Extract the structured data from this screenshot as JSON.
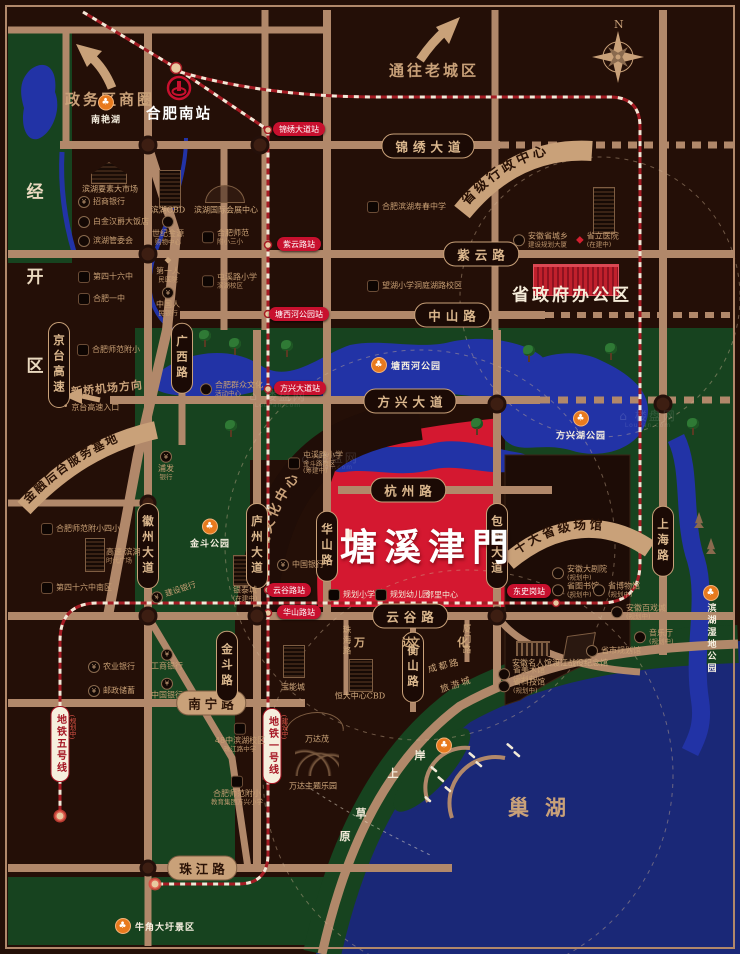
{
  "colors": {
    "bg": "#240f07",
    "road": "#b1886a",
    "green": "#17431f",
    "water": "#2233a6",
    "chaohu": "#1a2877",
    "red_area": "#d41830",
    "metro_red": "#a51c24",
    "tan": "#c9a179",
    "station_red": "#c8102e"
  },
  "compass": {
    "label": "N"
  },
  "project": {
    "name": "塘溪津門"
  },
  "banners": {
    "admin": "省级行政中心",
    "finance": "金融后台服务基地",
    "culture": "环湖文化中心",
    "venues": "十大省级场馆"
  },
  "watermark": {
    "text": "⌂ 楼盘网",
    "sub": "LouPan.com"
  },
  "metro": {
    "line1": {
      "name": "地铁一号线",
      "status": "(建设中)"
    },
    "line5": {
      "name": "地铁五号线",
      "status": "(规划中)"
    }
  },
  "items": [
    {
      "t": "pill-h",
      "id": "road-jinxiu-avenue",
      "x": 428,
      "y": 146,
      "tx": "锦绣大道"
    },
    {
      "t": "pill-h",
      "id": "road-ziyun-road",
      "x": 481,
      "y": 254,
      "tx": "紫云路"
    },
    {
      "t": "pill-h",
      "id": "road-zhongshan-road",
      "x": 452,
      "y": 315,
      "tx": "中山路"
    },
    {
      "t": "pill-h",
      "id": "road-fangxing-avenue",
      "x": 410,
      "y": 401,
      "tx": "方兴大道"
    },
    {
      "t": "pill-h",
      "id": "road-hangzhou-road",
      "x": 408,
      "y": 490,
      "tx": "杭州路"
    },
    {
      "t": "pill-h",
      "id": "road-yungu-road",
      "x": 410,
      "y": 616,
      "tx": "云谷路"
    },
    {
      "t": "pill-tan",
      "id": "road-nanning-road",
      "x": 211,
      "y": 703,
      "tx": "南宁路"
    },
    {
      "t": "pill-tan",
      "id": "road-zhujiang-road",
      "x": 202,
      "y": 868,
      "tx": "珠江路"
    },
    {
      "t": "pill-v",
      "id": "road-jingtai-expressway",
      "x": 59,
      "y": 365,
      "tx": "京台高速"
    },
    {
      "t": "pill-v",
      "id": "road-guangxi-road",
      "x": 182,
      "y": 358,
      "tx": "广西路"
    },
    {
      "t": "pill-v",
      "id": "road-huizhou-avenue",
      "x": 148,
      "y": 546,
      "tx": "徽州大道"
    },
    {
      "t": "pill-v",
      "id": "road-luzhou-avenue",
      "x": 257,
      "y": 546,
      "tx": "庐州大道"
    },
    {
      "t": "pill-v",
      "id": "road-huashan-road",
      "x": 327,
      "y": 546,
      "tx": "华山路"
    },
    {
      "t": "pill-v",
      "id": "road-baohe-avenue",
      "x": 497,
      "y": 546,
      "tx": "包河大道"
    },
    {
      "t": "pill-v",
      "id": "road-shanghai-road",
      "x": 663,
      "y": 541,
      "tx": "上海路"
    },
    {
      "t": "pill-v",
      "id": "road-jindou-road",
      "x": 227,
      "y": 666,
      "tx": "金斗路"
    },
    {
      "t": "pill-v",
      "id": "road-hengshan-road",
      "x": 413,
      "y": 667,
      "tx": "衡山路"
    },
    {
      "t": "station",
      "id": "station-jinxiu-avenue",
      "x": 299,
      "y": 129,
      "tx": "锦绣大道站"
    },
    {
      "t": "station",
      "id": "station-ziyun-road",
      "x": 299,
      "y": 244,
      "tx": "紫云路站"
    },
    {
      "t": "station",
      "id": "station-tangxihe-park",
      "x": 299,
      "y": 314,
      "tx": "塘西河公园站"
    },
    {
      "t": "station",
      "id": "station-fangxing-avenue",
      "x": 300,
      "y": 388,
      "tx": "方兴大道站"
    },
    {
      "t": "station",
      "id": "station-yungu-road",
      "x": 289,
      "y": 590,
      "tx": "云谷路站"
    },
    {
      "t": "station",
      "id": "station-huashan-road",
      "x": 299,
      "y": 612,
      "tx": "华山路站"
    },
    {
      "t": "station",
      "id": "station-dongshigang",
      "x": 529,
      "y": 591,
      "tx": "东史岗站"
    },
    {
      "t": "metrolabel",
      "id": "metro-line1-label",
      "x": 272,
      "y": 746,
      "tx": "地铁一号线"
    },
    {
      "t": "vtext-red",
      "id": "metro-line1-status",
      "x": 284,
      "y": 727,
      "tx": "(建设中)"
    },
    {
      "t": "metrolabel",
      "id": "metro-line5-label",
      "x": 60,
      "y": 744,
      "tx": "地铁五号线"
    },
    {
      "t": "vtext-red",
      "id": "metro-line5-status",
      "x": 72,
      "y": 727,
      "tx": "(规划中)"
    },
    {
      "t": "big",
      "id": "project-logo",
      "x": 428,
      "y": 544,
      "tx": "塘溪津門"
    },
    {
      "t": "seal",
      "id": "project-logo-seal",
      "x": 349,
      "y": 534
    },
    {
      "t": "big-white",
      "id": "gov-office-label",
      "x": 572,
      "y": 293,
      "tx": "省政府办公区"
    },
    {
      "t": "lake-big",
      "id": "chaohu-label",
      "x": 545,
      "y": 807,
      "tx": "巢湖"
    },
    {
      "t": "arrow-label",
      "id": "old-town-label",
      "x": 434,
      "y": 70,
      "tx": "通往老城区"
    },
    {
      "t": "arrow-label",
      "id": "gov-district-label",
      "x": 110,
      "y": 99,
      "tx": "政务区商圈"
    },
    {
      "t": "small-tan",
      "id": "airport-direction-label",
      "x": 107,
      "y": 388,
      "tx": "新桥机场方向",
      "r": -6
    },
    {
      "t": "white-bold",
      "id": "hefei-south-station-label",
      "x": 179,
      "y": 113,
      "tx": "合肥南站"
    },
    {
      "t": "zone-char",
      "id": "district-char-jing",
      "x": 35,
      "y": 190,
      "tx": "经"
    },
    {
      "t": "zone-char",
      "id": "district-char-kai",
      "x": 35,
      "y": 275,
      "tx": "开"
    },
    {
      "t": "zone-char",
      "id": "district-char-qu",
      "x": 35,
      "y": 364,
      "tx": "区"
    },
    {
      "t": "beach-char",
      "id": "beach-char-an",
      "x": 420,
      "y": 755,
      "tx": "岸"
    },
    {
      "t": "beach-char",
      "id": "beach-char-shang",
      "x": 393,
      "y": 773,
      "tx": "上"
    },
    {
      "t": "beach-char",
      "id": "beach-char-cao",
      "x": 361,
      "y": 813,
      "tx": "草"
    },
    {
      "t": "beach-char",
      "id": "beach-char-yuan",
      "x": 345,
      "y": 836,
      "tx": "原"
    },
    {
      "t": "street-sp",
      "id": "wanda-district-label",
      "x": 390,
      "y": 642,
      "tx": "万　达"
    },
    {
      "t": "street-sp",
      "id": "wenhua-district-label",
      "x": 445,
      "y": 642,
      "tx": "文　化"
    },
    {
      "t": "street-small",
      "id": "lvyoucheng-label",
      "x": 456,
      "y": 684,
      "tx": "旅游城",
      "r": -18
    },
    {
      "t": "street-small",
      "id": "chengdu-road-label",
      "x": 444,
      "y": 665,
      "tx": "成都路",
      "r": -14
    },
    {
      "t": "street-v",
      "id": "zhuhai-road-label",
      "x": 346,
      "y": 641,
      "tx": "珠海路"
    },
    {
      "t": "street-v",
      "id": "xiamen-road-label",
      "x": 466,
      "y": 640,
      "tx": "厦门路"
    },
    {
      "t": "park-col",
      "id": "park-nanyanhu",
      "x": 106,
      "y": 110,
      "tx": "南艳湖"
    },
    {
      "t": "park-row",
      "id": "park-tangxihe",
      "x": 371,
      "y": 365,
      "tx": "塘西河公园",
      "a": "l"
    },
    {
      "t": "park-col",
      "id": "park-fangxinghu",
      "x": 581,
      "y": 426,
      "tx": "方兴湖公园"
    },
    {
      "t": "park-col",
      "id": "park-jindou",
      "x": 210,
      "y": 534,
      "tx": "金斗公园"
    },
    {
      "t": "park-vert",
      "id": "park-binhu-wetland",
      "x": 711,
      "y": 630,
      "tx": "滨湖湿地公园"
    },
    {
      "t": "park-row",
      "id": "park-niujiao-scenic",
      "x": 115,
      "y": 926,
      "tx": "牛角大圩景区",
      "a": "l"
    },
    {
      "t": "park-icon",
      "id": "park-anshang-caoyuan-icon",
      "x": 444,
      "y": 743
    },
    {
      "t": "text-tan",
      "id": "poi-binhu-market",
      "x": 110,
      "y": 189,
      "tx": "滨湖要素大市场"
    },
    {
      "t": "poi-row",
      "id": "poi-zhaoshang-bank",
      "x": 78,
      "y": 202,
      "ic": "bank",
      "tx": "招商银行",
      "a": "l"
    },
    {
      "t": "poi-row",
      "id": "poi-baijinhanjue-hotel",
      "x": 78,
      "y": 222,
      "ic": "circle",
      "tx": "白金汉爵大饭店",
      "a": "l"
    },
    {
      "t": "poi-row",
      "id": "poi-binhu-committee",
      "x": 78,
      "y": 241,
      "ic": "circle",
      "tx": "滨湖管委会",
      "a": "l"
    },
    {
      "t": "text-tan",
      "id": "poi-binhu-cbd",
      "x": 168,
      "y": 210,
      "tx": "滨湖CBD"
    },
    {
      "t": "poi-col",
      "id": "poi-shijijinyuan-mall",
      "x": 168,
      "y": 231,
      "ic": "circle",
      "tx": "世纪金源",
      "s": "购物中心"
    },
    {
      "t": "text-tan",
      "id": "poi-binhu-convention-center",
      "x": 226,
      "y": 210,
      "tx": "滨湖国际会展中心"
    },
    {
      "t": "poi-row",
      "id": "poi-hefei-normal-third-primary",
      "x": 202,
      "y": 237,
      "ic": "school",
      "tx": "合肥师范",
      "s": "附小三小",
      "a": "l"
    },
    {
      "t": "poi-row",
      "id": "poi-no46-middle-school",
      "x": 78,
      "y": 277,
      "ic": "school",
      "tx": "第四十六中",
      "a": "l"
    },
    {
      "t": "poi-row",
      "id": "poi-hefei-no1-school",
      "x": 78,
      "y": 299,
      "ic": "school",
      "tx": "合肥一中",
      "a": "l"
    },
    {
      "t": "poi-col",
      "id": "poi-first-people-hospital",
      "x": 168,
      "y": 270,
      "ic": "diamond",
      "tx": "第一人",
      "s": "民医院"
    },
    {
      "t": "poi-col",
      "id": "poi-people-bank-china",
      "x": 168,
      "y": 302,
      "ic": "bank",
      "tx": "中国人",
      "s": "民银行"
    },
    {
      "t": "poi-row",
      "id": "poi-tunxi-primary-binhu",
      "x": 202,
      "y": 281,
      "ic": "school",
      "tx": "屯溪路小学",
      "s": "滨湖校区",
      "a": "l"
    },
    {
      "t": "poi-row",
      "id": "poi-binhu-shouchun-school",
      "x": 367,
      "y": 207,
      "ic": "school",
      "tx": "合肥滨湖寿春中学",
      "a": "l"
    },
    {
      "t": "poi-row",
      "id": "poi-wanghu-primary",
      "x": 367,
      "y": 286,
      "ic": "school",
      "tx": "望湖小学洞庭湖路校区",
      "a": "l"
    },
    {
      "t": "poi-row",
      "id": "poi-anhui-planning-tower",
      "x": 513,
      "y": 240,
      "ic": "circle",
      "tx": "安徽省城乡",
      "s": "建设规划大厦",
      "a": "l"
    },
    {
      "t": "poi-row",
      "id": "poi-provincial-hospital",
      "x": 576,
      "y": 240,
      "ic": "diamond-red",
      "tx": "省立医院",
      "s": "(在建中)",
      "a": "l"
    },
    {
      "t": "poi-row",
      "id": "poi-mass-culture-center",
      "x": 200,
      "y": 389,
      "ic": "circle",
      "tx": "合肥群众文化",
      "s": "活动中心",
      "a": "l"
    },
    {
      "t": "poi-row",
      "id": "poi-tunxi-primary-jindou",
      "x": 288,
      "y": 463,
      "ic": "school",
      "tx": "屯溪路小学",
      "s": "金斗路校区",
      "s2": "(筹建中)",
      "a": "l"
    },
    {
      "t": "poi-col",
      "id": "poi-pufa-bank",
      "x": 166,
      "y": 466,
      "ic": "bank",
      "tx": "浦发",
      "s": "银行"
    },
    {
      "t": "poi-row",
      "id": "poi-hefei-normal-primary",
      "x": 77,
      "y": 350,
      "ic": "school",
      "tx": "合肥师范附小",
      "a": "l"
    },
    {
      "t": "poi-row",
      "id": "poi-jingtai-entrance",
      "x": 63,
      "y": 408,
      "ic": "dot",
      "tx": "京台高速入口",
      "a": "l"
    },
    {
      "t": "poi-row",
      "id": "poi-normal-fourth-primary",
      "x": 41,
      "y": 529,
      "ic": "school",
      "tx": "合肥师范附小四小",
      "a": "l"
    },
    {
      "t": "poi-row",
      "id": "poi-gaosu-times-plaza",
      "x": 106,
      "y": 556,
      "tx": "高速·滨湖",
      "s": "时代广场",
      "a": "l"
    },
    {
      "t": "poi-row",
      "id": "poi-no46-south-campus",
      "x": 41,
      "y": 588,
      "ic": "school",
      "tx": "第四十六中南区",
      "a": "l"
    },
    {
      "t": "poi-row",
      "id": "poi-jianshe-bank",
      "x": 150,
      "y": 592,
      "ic": "bank",
      "tx": "建设银行",
      "r": -18,
      "a": "l"
    },
    {
      "t": "poi-col",
      "id": "poi-yintai-city",
      "x": 245,
      "y": 594,
      "tx": "银泰城",
      "s": "(在建中)"
    },
    {
      "t": "poi-row",
      "id": "poi-bank-of-china-north",
      "x": 277,
      "y": 565,
      "ic": "bank",
      "tx": "中国银行",
      "a": "l"
    },
    {
      "t": "poi-row",
      "id": "poi-agri-bank",
      "x": 88,
      "y": 667,
      "ic": "bank",
      "tx": "农业银行",
      "a": "l"
    },
    {
      "t": "poi-row",
      "id": "poi-postal-savings",
      "x": 88,
      "y": 691,
      "ic": "bank",
      "tx": "邮政储蓄",
      "a": "l"
    },
    {
      "t": "poi-col",
      "id": "poi-icbc-bank",
      "x": 167,
      "y": 660,
      "ic": "bank",
      "tx": "工商银行"
    },
    {
      "t": "poi-col",
      "id": "poi-bank-of-china-south",
      "x": 167,
      "y": 689,
      "ic": "bank",
      "tx": "中国银行"
    },
    {
      "t": "poi-col",
      "id": "poi-no48-binhu-campus",
      "x": 240,
      "y": 738,
      "ic": "school",
      "tx": "48中滨湖校区",
      "s": "珠江路中学"
    },
    {
      "t": "text-tan",
      "id": "poi-baoneng-city",
      "x": 293,
      "y": 687,
      "tx": "宝能城"
    },
    {
      "t": "text-tan",
      "id": "poi-hengda-cbd",
      "x": 360,
      "y": 696,
      "tx": "恒大中心CBD"
    },
    {
      "t": "text-tan",
      "id": "poi-wanda-mao",
      "x": 317,
      "y": 739,
      "tx": "万达茂"
    },
    {
      "t": "text-tan",
      "id": "poi-wanda-theme-park",
      "x": 313,
      "y": 786,
      "tx": "万达主题乐园"
    },
    {
      "t": "poi-col",
      "id": "poi-normal-fangxing-primary",
      "x": 237,
      "y": 791,
      "ic": "school",
      "tx": "合肥师范附小",
      "s": "教育集团方兴小学"
    },
    {
      "t": "poi-row-white",
      "id": "poi-planned-primary-school",
      "x": 328,
      "y": 595,
      "ic": "school",
      "tx": "规划小学",
      "a": "l"
    },
    {
      "t": "poi-row-white",
      "id": "poi-planned-kindergarten",
      "x": 375,
      "y": 595,
      "ic": "school",
      "tx": "规划幼儿园",
      "a": "l"
    },
    {
      "t": "text-white",
      "id": "poi-neighborhood-center",
      "x": 442,
      "y": 595,
      "tx": "邻里中心"
    },
    {
      "t": "poi-row",
      "id": "poi-anhui-grand-theater",
      "x": 552,
      "y": 573,
      "ic": "circle",
      "tx": "安徽大剧院",
      "s": "(规划中)",
      "a": "l"
    },
    {
      "t": "poi-row",
      "id": "poi-provincial-library",
      "x": 552,
      "y": 590,
      "ic": "circle",
      "tx": "省图书馆",
      "s": "(规划中)",
      "a": "l"
    },
    {
      "t": "poi-row",
      "id": "poi-provincial-museum",
      "x": 593,
      "y": 590,
      "ic": "circle",
      "tx": "省博物馆",
      "s": "(规划中)",
      "a": "l"
    },
    {
      "t": "poi-row",
      "id": "poi-anhui-opera-city",
      "x": 611,
      "y": 612,
      "ic": "circle",
      "tx": "安徽百戏城",
      "s": "(规划中)",
      "a": "l"
    },
    {
      "t": "poi-row",
      "id": "poi-concert-hall",
      "x": 634,
      "y": 637,
      "ic": "circle",
      "tx": "音乐厅",
      "s": "(规划中)",
      "a": "l"
    },
    {
      "t": "poi-row",
      "id": "poi-city-planning-hall",
      "x": 586,
      "y": 651,
      "ic": "circle",
      "tx": "省市规划馆",
      "a": "l"
    },
    {
      "t": "text-tan",
      "id": "poi-anhui-celebrity-hall",
      "x": 532,
      "y": 663,
      "tx": "安徽名人馆"
    },
    {
      "t": "text-tan",
      "id": "poi-dujiang-memorial",
      "x": 580,
      "y": 663,
      "tx": "渡江战役纪念馆"
    },
    {
      "t": "poi-row",
      "id": "poi-provincial-art-museum",
      "x": 498,
      "y": 674,
      "ic": "circle",
      "tx": "省美术馆",
      "s": "(规划中)",
      "a": "l"
    },
    {
      "t": "poi-row",
      "id": "poi-provincial-science-museum",
      "x": 498,
      "y": 686,
      "ic": "circle",
      "tx": "省科技馆",
      "s": "(规划中)",
      "a": "l"
    },
    {
      "t": "bldg",
      "id": "building-binhu-market",
      "x": 91,
      "y": 162,
      "w": 36,
      "h": 22,
      "k": "roof"
    },
    {
      "t": "bldg",
      "id": "building-binhu-cbd",
      "x": 159,
      "y": 170,
      "w": 20,
      "h": 36,
      "k": "towers"
    },
    {
      "t": "bldg",
      "id": "building-convention-center",
      "x": 205,
      "y": 185,
      "w": 38,
      "h": 16,
      "k": "dome"
    },
    {
      "t": "bldg",
      "id": "building-provincial-hospital",
      "x": 593,
      "y": 187,
      "w": 20,
      "h": 45,
      "k": "tower"
    },
    {
      "t": "bldg",
      "id": "building-gov-office",
      "x": 533,
      "y": 264,
      "w": 84,
      "h": 28,
      "k": "gov"
    },
    {
      "t": "bldg",
      "id": "building-times-plaza",
      "x": 85,
      "y": 538,
      "w": 18,
      "h": 32,
      "k": "towers"
    },
    {
      "t": "bldg",
      "id": "building-yintai-city",
      "x": 233,
      "y": 555,
      "w": 20,
      "h": 29,
      "k": "towers"
    },
    {
      "t": "bldg",
      "id": "building-baoneng-city",
      "x": 283,
      "y": 645,
      "w": 20,
      "h": 31,
      "k": "towers"
    },
    {
      "t": "bldg",
      "id": "building-hengda-cbd",
      "x": 349,
      "y": 659,
      "w": 22,
      "h": 31,
      "k": "towers"
    },
    {
      "t": "bldg",
      "id": "building-wanda-mao",
      "x": 287,
      "y": 712,
      "w": 56,
      "h": 18,
      "k": "domeline"
    },
    {
      "t": "bldg",
      "id": "building-roller-coaster",
      "x": 295,
      "y": 749,
      "w": 44,
      "h": 27,
      "k": "coaster"
    },
    {
      "t": "bldg",
      "id": "building-dujiang-memorial",
      "x": 565,
      "y": 634,
      "w": 26,
      "h": 25,
      "k": "memorial"
    },
    {
      "t": "bldg",
      "id": "building-celebrity-hall",
      "x": 516,
      "y": 641,
      "w": 34,
      "h": 13,
      "k": "museum"
    },
    {
      "t": "tree",
      "x": 198,
      "y": 330
    },
    {
      "t": "tree",
      "x": 228,
      "y": 338
    },
    {
      "t": "tree",
      "x": 280,
      "y": 340
    },
    {
      "t": "tree",
      "x": 522,
      "y": 345
    },
    {
      "t": "tree",
      "x": 604,
      "y": 343
    },
    {
      "t": "tree",
      "x": 686,
      "y": 418
    },
    {
      "t": "tree",
      "x": 224,
      "y": 420
    },
    {
      "t": "tree",
      "x": 470,
      "y": 418
    },
    {
      "t": "pine",
      "x": 694,
      "y": 512
    },
    {
      "t": "pine",
      "x": 706,
      "y": 538
    },
    {
      "t": "wm",
      "x": 278,
      "y": 400
    },
    {
      "t": "wm",
      "x": 330,
      "y": 462
    },
    {
      "t": "wm",
      "x": 648,
      "y": 420
    }
  ]
}
